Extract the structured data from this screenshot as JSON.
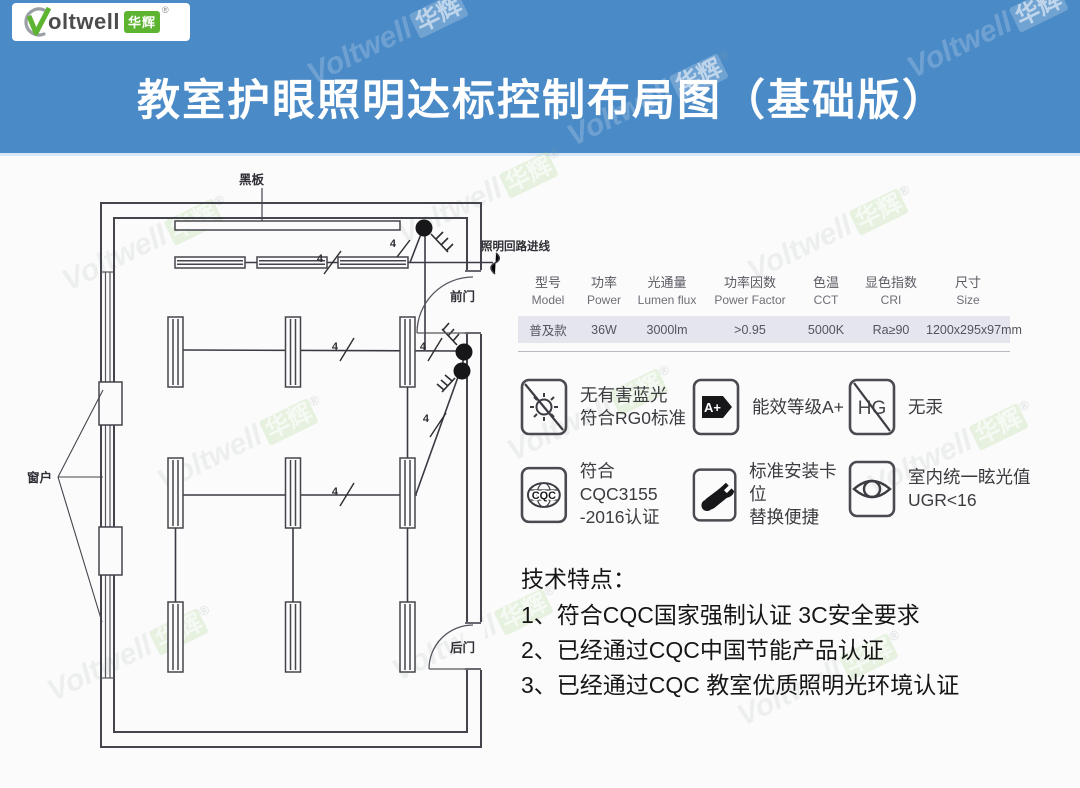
{
  "logo": {
    "brand": "oltwell",
    "badge": "华辉",
    "registered": "®"
  },
  "title": "教室护眼照明达标控制布局图（基础版）",
  "watermark": {
    "brand": "Voltwell",
    "cjk": "华辉",
    "registered": "®"
  },
  "diagram": {
    "labels": {
      "blackboard": "黑板",
      "window": "窗户",
      "front_door": "前门",
      "back_door": "后门",
      "incoming_line": "照明回路进线",
      "wire_count": "4"
    }
  },
  "spec_table": {
    "columns": [
      {
        "zh": "型号",
        "en": "Model"
      },
      {
        "zh": "功率",
        "en": "Power"
      },
      {
        "zh": "光通量",
        "en": "Lumen flux"
      },
      {
        "zh": "功率因数",
        "en": "Power Factor"
      },
      {
        "zh": "色温",
        "en": "CCT"
      },
      {
        "zh": "显色指数",
        "en": "CRI"
      },
      {
        "zh": "尺寸",
        "en": "Size"
      }
    ],
    "rows": [
      [
        "普及款",
        "36W",
        "3000lm",
        ">0.95",
        "5000K",
        "Ra≥90",
        "1200x295x97mm"
      ]
    ]
  },
  "features": [
    {
      "icon": "no-blue-light-icon",
      "lines": [
        "无有害蓝光",
        "符合RG0标准"
      ]
    },
    {
      "icon": "energy-label-icon",
      "glyph": "A+",
      "lines": [
        "能效等级A+"
      ]
    },
    {
      "icon": "no-mercury-icon",
      "glyph": "HG",
      "lines": [
        "无汞"
      ]
    },
    {
      "icon": "cqc-cert-icon",
      "glyph": "CQC",
      "lines": [
        "符合CQC3155",
        "-2016认证"
      ]
    },
    {
      "icon": "easy-install-icon",
      "lines": [
        "标准安装卡位",
        "替换便捷"
      ]
    },
    {
      "icon": "eye-glare-icon",
      "lines": [
        "室内统一眩光值",
        "UGR<16"
      ]
    }
  ],
  "tech_features": {
    "heading": "技术特点：",
    "items": [
      "1、符合CQC国家强制认证 3C安全要求",
      "2、已经通过CQC中国节能产品认证",
      "3、已经通过CQC 教室优质照明光环境认证"
    ]
  },
  "colors": {
    "banner_blue": "#4a8ac6",
    "logo_green": "#5cb430",
    "table_row_bg": "#e4e5ed",
    "diagram_line": "#44444c"
  }
}
